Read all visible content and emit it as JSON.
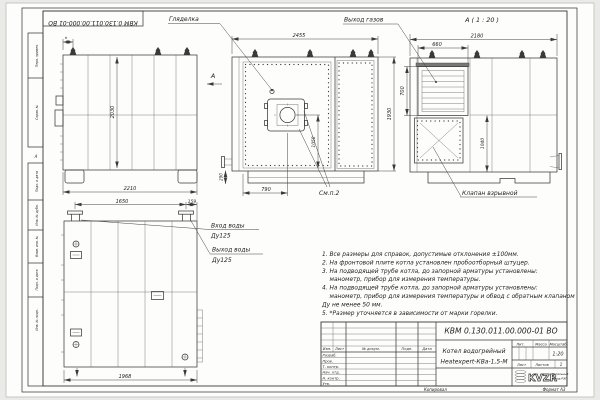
{
  "frame": {
    "doc_number_top": "КВМ 0.130.011.00.000-01 ВО",
    "zone_letter": "А",
    "margin_labels": [
      "Перв. примен.",
      "Справ. №",
      "Подп. и дата",
      "Инв. № дубл.",
      "Взам. инв. №",
      "Подп. и дата",
      "Инв. № подл."
    ]
  },
  "labels": {
    "peephole": "Гляделка",
    "gas_outlet": "Выход газов",
    "view_a_title": "А ( 1 : 20 )",
    "view_arrow_letter": "А",
    "see_note": "См.п.2",
    "water_inlet_line1": "Вход воды",
    "water_inlet_line2": "Ду125",
    "water_outlet_line1": "Выход воды",
    "water_outlet_line2": "Ду125",
    "explosion_valve": "Клапан взрывной"
  },
  "dims": {
    "front_width": "2455",
    "view_a_width": "2180",
    "grille_width": "660",
    "side_height": "2030",
    "side_width": "2210",
    "asterisk": "*",
    "base_height": "290",
    "burner_axis": "1058",
    "front_height": "1930",
    "burner_offset": "790",
    "grille_height": "700",
    "rear_height": "1040",
    "pipes_spacing": "1650",
    "pipe_to_edge": "159",
    "bottom_width": "1968"
  },
  "notes": {
    "lines": [
      "1. Все размеры для справок, допустимые отклонения ±100мм.",
      "2. На фронтовой плите котла установлен пробоотборный штуцер.",
      "3. На подводящей трубе котла, до запорной арматуры установлены:",
      "манометр, прибор для измерения температуры.",
      "4. На подводящей трубе котла, до запорной арматуры установлены:",
      "манометр, прибор для измерения температуры и обвод с обратным клапаном",
      "Ду не менее 50 мм.",
      "5. *Размер уточняется в зависимости от марки горелки."
    ]
  },
  "title_block": {
    "doc_number": "КВМ 0.130.011.00.000-01 ВО",
    "product_name_line1": "Котел водогрейный",
    "product_name_line2": "Heatexpert-КВа-1,5-М",
    "col_izm": "Изм.",
    "col_list": "Лист",
    "col_doc": "№ докум.",
    "col_podp": "Подп.",
    "col_data": "Дата",
    "rows": [
      "Разраб.",
      "Пров.",
      "Т. контр.",
      "Нач. отд.",
      "Н. контр.",
      "Утв."
    ],
    "lit_label": "Лит.",
    "mass_label": "Масса",
    "scale_label": "Масштаб",
    "scale_value": "1:20",
    "sheet_label": "Лист",
    "sheets_label": "Листов",
    "sheets_value": "1",
    "logo_text": "KVZR",
    "logo_sub_line1": "Котельный",
    "logo_sub_line2": "завод РЭП",
    "copied_label": "Копировал",
    "format_label": "Формат А3"
  }
}
